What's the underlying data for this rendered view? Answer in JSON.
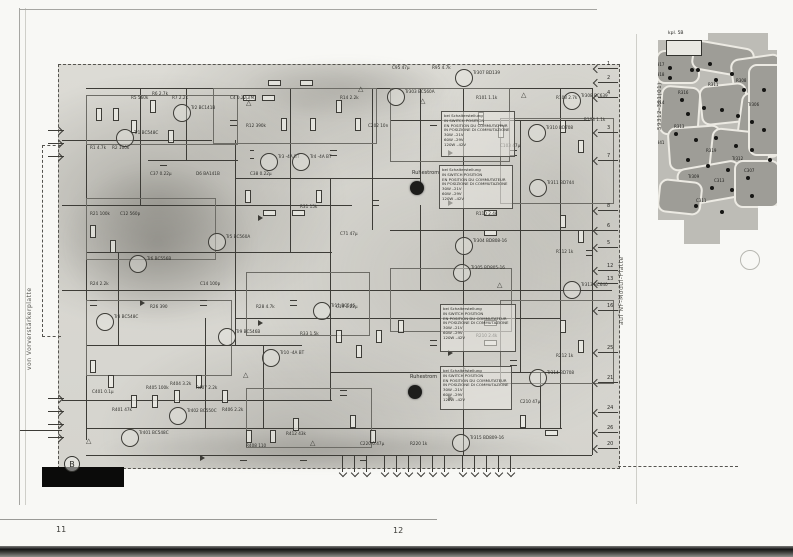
{
  "page": {
    "left_number": "11",
    "right_number": "12",
    "section_mark": "B"
  },
  "side_labels": {
    "left": "von Vorverstärkerplatte",
    "right": "auf NF-Modul-Platte"
  },
  "pcb": {
    "board_number": "59312-321(01)",
    "connector_label": "kpl. 5B",
    "traces": [
      [
        6,
        22,
        40,
        30,
        0
      ],
      [
        42,
        16,
        58,
        26,
        10
      ],
      [
        82,
        28,
        48,
        42,
        -8
      ],
      [
        10,
        58,
        36,
        46,
        4
      ],
      [
        50,
        56,
        44,
        36,
        -6
      ],
      [
        88,
        66,
        42,
        58,
        8
      ],
      [
        18,
        98,
        50,
        40,
        -4
      ],
      [
        60,
        102,
        56,
        44,
        6
      ],
      [
        28,
        136,
        60,
        34,
        -10
      ],
      [
        84,
        132,
        42,
        44,
        0
      ],
      [
        8,
        152,
        40,
        30,
        6
      ],
      [
        98,
        36,
        34,
        88,
        0
      ]
    ],
    "pads": [
      [
        22,
        20
      ],
      [
        28,
        20
      ],
      [
        34,
        20
      ],
      [
        40,
        20
      ],
      [
        18,
        38
      ],
      [
        18,
        48
      ],
      [
        40,
        40
      ],
      [
        46,
        40
      ],
      [
        58,
        34
      ],
      [
        64,
        50
      ],
      [
        80,
        44
      ],
      [
        92,
        60
      ],
      [
        30,
        70
      ],
      [
        36,
        84
      ],
      [
        52,
        78
      ],
      [
        70,
        80
      ],
      [
        86,
        86
      ],
      [
        100,
        92
      ],
      [
        24,
        104
      ],
      [
        44,
        110
      ],
      [
        64,
        108
      ],
      [
        84,
        116
      ],
      [
        100,
        120
      ],
      [
        36,
        130
      ],
      [
        56,
        136
      ],
      [
        76,
        140
      ],
      [
        96,
        148
      ],
      [
        112,
        60
      ],
      [
        112,
        100
      ],
      [
        118,
        130
      ],
      [
        60,
        158
      ],
      [
        80,
        160
      ],
      [
        100,
        166
      ],
      [
        44,
        176
      ],
      [
        70,
        182
      ]
    ],
    "labels": [
      [
        4,
        34,
        "R317"
      ],
      [
        4,
        44,
        "R318"
      ],
      [
        28,
        62,
        "R316"
      ],
      [
        4,
        72,
        "R314"
      ],
      [
        58,
        54,
        "R311"
      ],
      [
        86,
        50,
        "R308"
      ],
      [
        24,
        96,
        "R313"
      ],
      [
        4,
        112,
        "R341"
      ],
      [
        56,
        120,
        "R319"
      ],
      [
        82,
        128,
        "Tr312"
      ],
      [
        38,
        146,
        "Tr309"
      ],
      [
        64,
        150,
        "C313"
      ],
      [
        94,
        140,
        "C307"
      ],
      [
        98,
        74,
        "Tr306"
      ],
      [
        46,
        170,
        "C311"
      ]
    ]
  },
  "notes": {
    "intro_lines": [
      "bei Schalterstellung",
      "IN SWITCH POSITION",
      "EN POSITION DU COMMUTATEUR",
      "IN POSIZIONE DI COMMUTAZIONE"
    ],
    "voltage_lines": [
      "30W  –21V",
      "60W  –29V",
      "120W  –42V"
    ],
    "boxes": [
      [
        441,
        111,
        68,
        40
      ],
      [
        439,
        165,
        68,
        38
      ],
      [
        440,
        304,
        70,
        42
      ],
      [
        440,
        366,
        66,
        38
      ]
    ]
  },
  "schematic": {
    "trimmer_label": "Ruhestrom",
    "trimmers": [
      [
        410,
        181
      ],
      [
        408,
        385
      ]
    ],
    "transistors": [
      [
        124,
        137,
        "Tr1 BC548C"
      ],
      [
        181,
        112,
        "Tr2 BC141B"
      ],
      [
        268,
        161,
        "Tr3 -4A BT"
      ],
      [
        300,
        161,
        "Tr4 -4A BT"
      ],
      [
        216,
        241,
        "Tr5 BC560A"
      ],
      [
        137,
        263,
        "Tr6 BC556B"
      ],
      [
        104,
        321,
        "Tr8 BC548C"
      ],
      [
        226,
        336,
        "Tr9 BC546B"
      ],
      [
        270,
        357,
        "Tr10 -4A BT"
      ],
      [
        321,
        310,
        "Tr11 BC546"
      ],
      [
        129,
        437,
        "Tr401 BC548C"
      ],
      [
        177,
        415,
        "Tr402 BC550C"
      ],
      [
        395,
        96,
        "Tr303 BC560A"
      ],
      [
        463,
        77,
        "Tr307 BD139"
      ],
      [
        571,
        100,
        "Tr308 BC639"
      ],
      [
        536,
        132,
        "Tr310 BD708"
      ],
      [
        537,
        187,
        "Tr311 BD744"
      ],
      [
        463,
        245,
        "Tr304 BD808-16"
      ],
      [
        461,
        272,
        "Tr305 BD805-16"
      ],
      [
        571,
        289,
        "Tr313 BC640"
      ],
      [
        537,
        377,
        "Tr314 BD708"
      ],
      [
        460,
        442,
        "Tr315 BD809-16"
      ]
    ],
    "resistors": [
      [
        96,
        108,
        "v"
      ],
      [
        113,
        108,
        "v"
      ],
      [
        131,
        120,
        "v"
      ],
      [
        150,
        100,
        "v"
      ],
      [
        168,
        130,
        "v"
      ],
      [
        243,
        95,
        "h"
      ],
      [
        262,
        95,
        "h"
      ],
      [
        281,
        118,
        "v"
      ],
      [
        310,
        118,
        "v"
      ],
      [
        336,
        100,
        "v"
      ],
      [
        355,
        118,
        "v"
      ],
      [
        245,
        190,
        "v"
      ],
      [
        263,
        210,
        "h"
      ],
      [
        292,
        210,
        "h"
      ],
      [
        316,
        190,
        "v"
      ],
      [
        90,
        225,
        "v"
      ],
      [
        110,
        240,
        "v"
      ],
      [
        90,
        360,
        "v"
      ],
      [
        108,
        375,
        "v"
      ],
      [
        131,
        395,
        "v"
      ],
      [
        152,
        395,
        "v"
      ],
      [
        174,
        390,
        "v"
      ],
      [
        196,
        375,
        "v"
      ],
      [
        222,
        390,
        "v"
      ],
      [
        246,
        430,
        "v"
      ],
      [
        270,
        430,
        "v"
      ],
      [
        293,
        418,
        "v"
      ],
      [
        336,
        330,
        "v"
      ],
      [
        356,
        345,
        "v"
      ],
      [
        376,
        330,
        "v"
      ],
      [
        398,
        320,
        "v"
      ],
      [
        478,
        112,
        "v"
      ],
      [
        498,
        125,
        "v"
      ],
      [
        560,
        120,
        "v"
      ],
      [
        578,
        140,
        "v"
      ],
      [
        484,
        210,
        "h"
      ],
      [
        484,
        230,
        "h"
      ],
      [
        560,
        215,
        "v"
      ],
      [
        578,
        230,
        "v"
      ],
      [
        484,
        320,
        "h"
      ],
      [
        484,
        340,
        "h"
      ],
      [
        560,
        320,
        "v"
      ],
      [
        578,
        340,
        "v"
      ],
      [
        520,
        415,
        "v"
      ],
      [
        545,
        430,
        "h"
      ],
      [
        370,
        430,
        "v"
      ],
      [
        350,
        415,
        "v"
      ],
      [
        268,
        80,
        "h"
      ],
      [
        300,
        80,
        "h"
      ]
    ],
    "capacitors": [
      [
        160,
        160,
        "v"
      ],
      [
        230,
        120,
        "v"
      ],
      [
        250,
        150,
        "h"
      ],
      [
        330,
        150,
        "v"
      ],
      [
        372,
        200,
        "v"
      ],
      [
        90,
        300,
        "v"
      ],
      [
        200,
        300,
        "v"
      ],
      [
        290,
        300,
        "v"
      ],
      [
        340,
        390,
        "v"
      ],
      [
        430,
        120,
        "v"
      ],
      [
        430,
        340,
        "v"
      ],
      [
        510,
        150,
        "v"
      ],
      [
        510,
        360,
        "v"
      ],
      [
        586,
        250,
        "v"
      ],
      [
        240,
        455,
        "v"
      ],
      [
        300,
        455,
        "v"
      ],
      [
        360,
        455,
        "v"
      ]
    ],
    "diodes": [
      [
        258,
        215
      ],
      [
        258,
        320
      ],
      [
        448,
        150
      ],
      [
        448,
        200
      ],
      [
        448,
        350
      ],
      [
        448,
        395
      ],
      [
        200,
        455
      ],
      [
        140,
        300
      ]
    ],
    "warn_triangles": [
      [
        246,
        100
      ],
      [
        358,
        86
      ],
      [
        420,
        98
      ],
      [
        521,
        92
      ],
      [
        497,
        282
      ],
      [
        243,
        372
      ],
      [
        86,
        438
      ],
      [
        462,
        367
      ],
      [
        310,
        440
      ]
    ],
    "sub_boxes": [
      [
        86,
        95,
        150,
        48
      ],
      [
        213,
        88,
        162,
        54
      ],
      [
        390,
        88,
        118,
        72
      ],
      [
        500,
        118,
        112,
        84
      ],
      [
        86,
        198,
        128,
        60
      ],
      [
        246,
        272,
        122,
        62
      ],
      [
        86,
        300,
        144,
        74
      ],
      [
        390,
        268,
        120,
        62
      ],
      [
        246,
        388,
        124,
        58
      ],
      [
        500,
        300,
        112,
        82
      ]
    ],
    "wires_h": [
      [
        86,
        88,
        506
      ],
      [
        390,
        120,
        200
      ],
      [
        62,
        140,
        150
      ],
      [
        235,
        178,
        185
      ],
      [
        62,
        205,
        290
      ],
      [
        390,
        230,
        222
      ],
      [
        86,
        252,
        246
      ],
      [
        62,
        290,
        550
      ],
      [
        235,
        318,
        325
      ],
      [
        86,
        345,
        216
      ],
      [
        330,
        372,
        230
      ],
      [
        62,
        400,
        270
      ],
      [
        86,
        428,
        476
      ],
      [
        86,
        455,
        506
      ],
      [
        148,
        160,
        90
      ],
      [
        20,
        430,
        42
      ]
    ],
    "wires_v": [
      [
        86,
        100,
        340
      ],
      [
        140,
        88,
        117
      ],
      [
        186,
        88,
        72
      ],
      [
        235,
        140,
        205
      ],
      [
        290,
        88,
        164
      ],
      [
        330,
        178,
        222
      ],
      [
        372,
        88,
        142
      ],
      [
        420,
        88,
        100
      ],
      [
        420,
        205,
        85
      ],
      [
        463,
        88,
        367
      ],
      [
        520,
        120,
        252
      ],
      [
        560,
        88,
        340
      ],
      [
        592,
        88,
        367
      ],
      [
        118,
        252,
        93
      ],
      [
        205,
        318,
        110
      ],
      [
        263,
        345,
        83
      ],
      [
        540,
        372,
        56
      ]
    ],
    "right_pins": [
      [
        68,
        "1"
      ],
      [
        82,
        "2"
      ],
      [
        97,
        "4"
      ],
      [
        132,
        "3"
      ],
      [
        160,
        "7"
      ],
      [
        210,
        "8"
      ],
      [
        230,
        "6"
      ],
      [
        247,
        "5"
      ],
      [
        270,
        "12"
      ],
      [
        283,
        "13"
      ],
      [
        310,
        "16"
      ],
      [
        352,
        "25"
      ],
      [
        382,
        "21"
      ],
      [
        412,
        "24"
      ],
      [
        432,
        "26"
      ],
      [
        448,
        "20"
      ]
    ],
    "bottom_pin_xs": [
      342,
      354,
      366,
      384,
      396,
      408,
      420,
      432,
      444,
      462,
      474,
      486,
      498,
      510
    ],
    "left_pin_ys": [
      130,
      143,
      156,
      398,
      411,
      424,
      437
    ],
    "misc_labels": [
      [
        131,
        96,
        "R5 560k"
      ],
      [
        152,
        92,
        "R6 2.7k"
      ],
      [
        172,
        96,
        "R7 2.2k"
      ],
      [
        90,
        146,
        "R1 4.7k"
      ],
      [
        112,
        146,
        "R2 100k"
      ],
      [
        230,
        96,
        "C4 0.22µ(M)"
      ],
      [
        246,
        124,
        "R12 390k"
      ],
      [
        150,
        172,
        "C37 0.22µ"
      ],
      [
        196,
        172,
        "D6 BA141B"
      ],
      [
        250,
        172,
        "C38 0.22µ"
      ],
      [
        340,
        96,
        "R14 2.2k"
      ],
      [
        368,
        124,
        "C202 10n"
      ],
      [
        300,
        205,
        "R31 15k"
      ],
      [
        340,
        232,
        "C71 47µ"
      ],
      [
        90,
        212,
        "R21 100k"
      ],
      [
        120,
        212,
        "C12 560p"
      ],
      [
        90,
        282,
        "R24 2.2k"
      ],
      [
        150,
        305,
        "R26 390"
      ],
      [
        200,
        282,
        "C14 100p"
      ],
      [
        256,
        305,
        "R28 4.7k"
      ],
      [
        300,
        332,
        "R33 1.5k"
      ],
      [
        336,
        305,
        "C19 0.22µ"
      ],
      [
        92,
        390,
        "C401 0.1µ"
      ],
      [
        112,
        408,
        "R401 47k"
      ],
      [
        146,
        386,
        "R405 100k"
      ],
      [
        170,
        382,
        "R404 3.2k"
      ],
      [
        196,
        386,
        "R407 2.2k"
      ],
      [
        222,
        408,
        "R406 2.2k"
      ],
      [
        246,
        444,
        "R408 110"
      ],
      [
        286,
        432,
        "R412 43k"
      ],
      [
        476,
        96,
        "R101 1.1k"
      ],
      [
        500,
        144,
        "C103 47µ"
      ],
      [
        556,
        96,
        "R103 2.7k"
      ],
      [
        584,
        118,
        "R104 1.1k"
      ],
      [
        476,
        212,
        "R110 2.4k"
      ],
      [
        556,
        250,
        "R112 1k"
      ],
      [
        476,
        334,
        "R210 2.4k"
      ],
      [
        556,
        354,
        "R212 1k"
      ],
      [
        520,
        400,
        "C210 47µ"
      ],
      [
        360,
        442,
        "C220 0.47µ"
      ],
      [
        410,
        442,
        "R220 1k"
      ],
      [
        392,
        66,
        "C95 47µ"
      ],
      [
        432,
        66,
        "R95 4.7k"
      ]
    ]
  }
}
